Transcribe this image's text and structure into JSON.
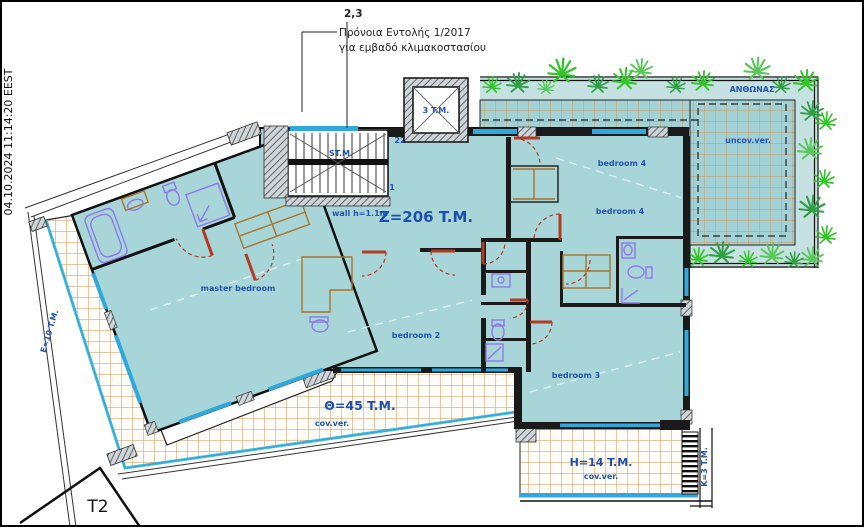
{
  "stamp": {
    "datetime": "04.10.2024 11:14:20 EEST"
  },
  "sheet": {
    "mark": "T2"
  },
  "annotation": {
    "ref": "2,3",
    "line1": "Πρόνοια Εντολής 1/2017",
    "line2": "για εμβαδό κλιμακοστασίου"
  },
  "areas": {
    "main": "Z=206 T.M.",
    "stair_core": "ST.M.",
    "stair_top": "22",
    "stair_bottom": "1",
    "wall_note": "wall h=1.1m",
    "elevator": "3 T.M.",
    "theta": "Θ=45 T.M.",
    "cov_tag": "cov.ver.",
    "h": "H=14 T.M.",
    "uncov": "uncov.ver.",
    "flower_bed": "ΑΝΘΩΝΑΣ",
    "e": "E=10 T.M.",
    "k": "K=3 T.M."
  },
  "rooms": {
    "master": "master bedroom",
    "bedroom2": "bedroom 2",
    "bedroom3": "bedroom 3",
    "bedroom4": "bedroom 4"
  },
  "colors": {
    "room_fill": "#a7d5d8",
    "tile_grid": "#d0945c",
    "window": "#2fa9dc",
    "door": "#b23b22",
    "fixture": "#8d7ae8",
    "furniture": "#a8752c",
    "plant": "#35c32c",
    "label": "#2155ac"
  }
}
